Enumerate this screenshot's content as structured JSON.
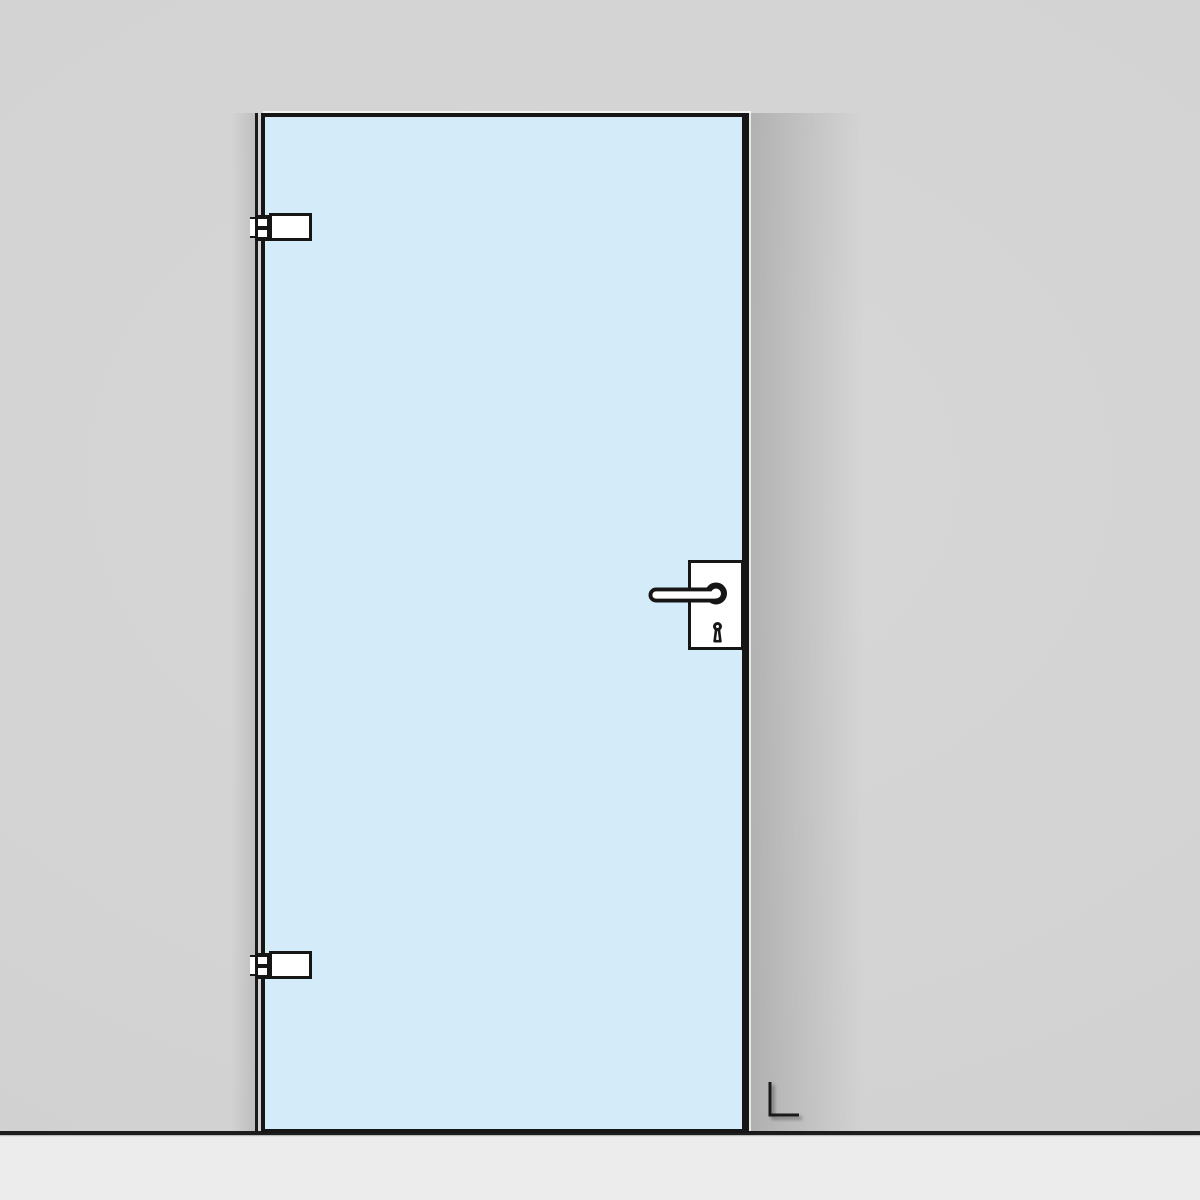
{
  "illustration": {
    "subject": "frameless glass door elevation",
    "hinge_side_label": "L",
    "components": {
      "door_panel": "glass-door-panel",
      "top_hinge": "top-hinge",
      "bottom_hinge": "bottom-hinge",
      "handle": "lever-handle",
      "lock_plate": "lock-plate",
      "keyhole": "keyhole-icon",
      "hinge_mark": "hinge-side-mark"
    },
    "colors": {
      "wall": "#d3d3d3",
      "floor": "#ececec",
      "floor_line": "#1d1d1d",
      "glass": "#d4ecfa",
      "outline": "#161616",
      "fittings": "#ffffff"
    }
  }
}
